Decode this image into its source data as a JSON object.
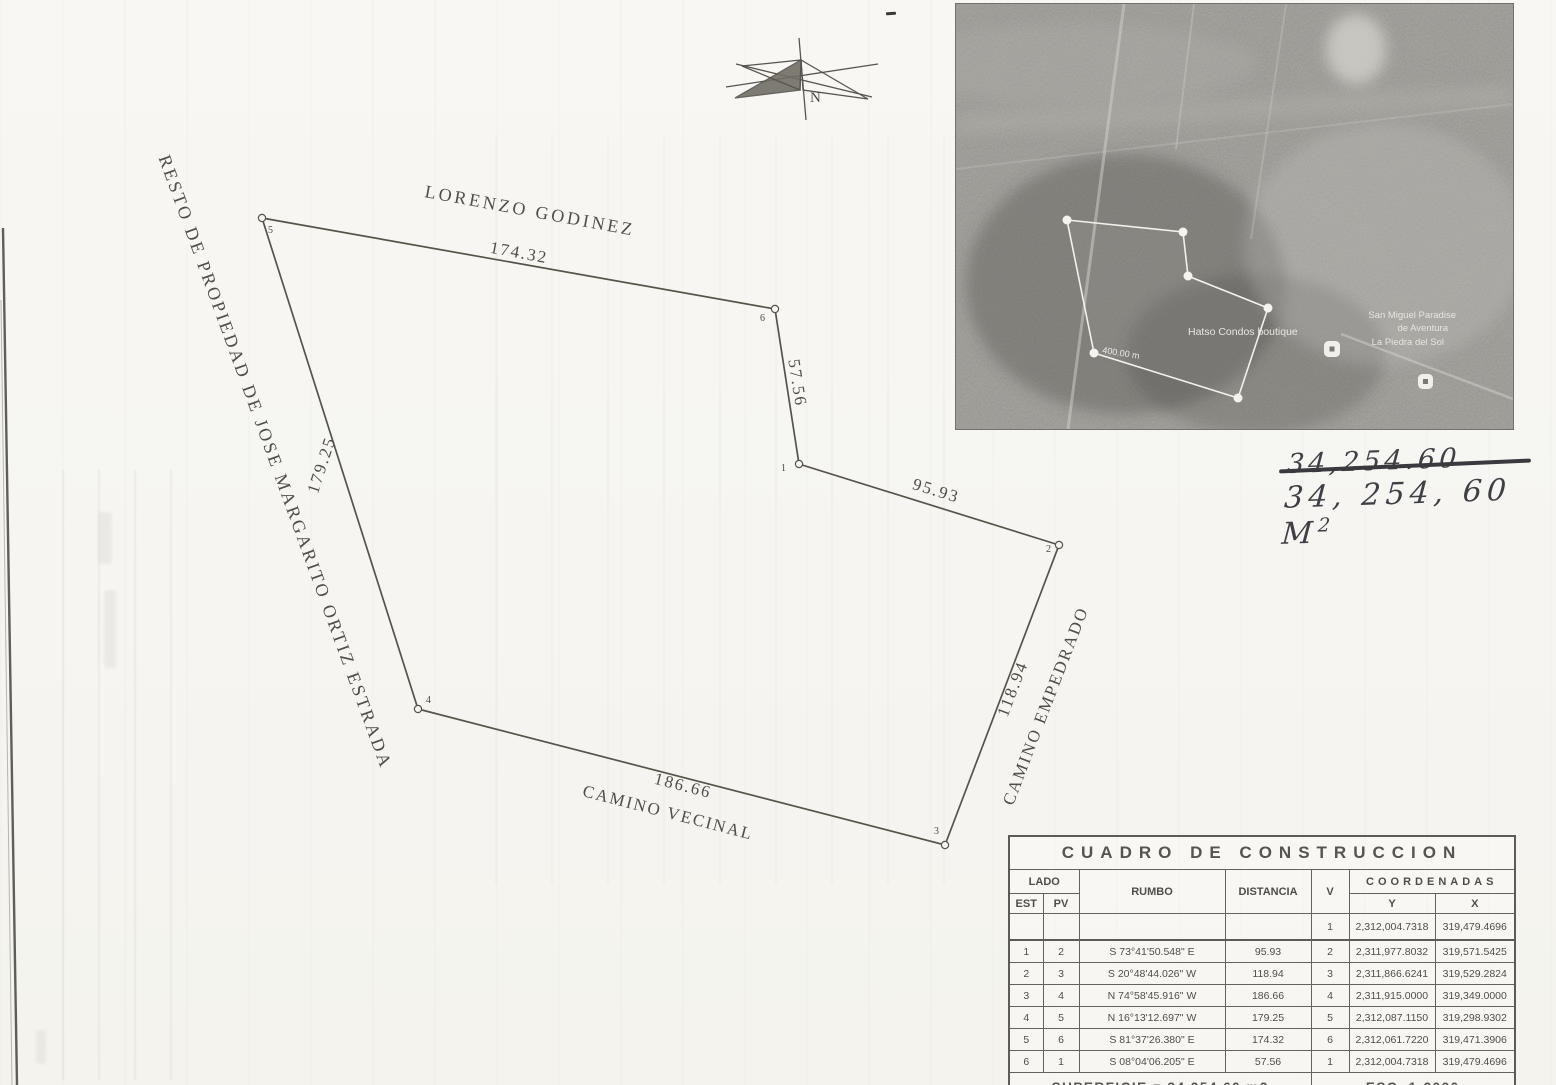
{
  "drawing": {
    "north_label": "N",
    "adjoiners": {
      "top": "LORENZO GODINEZ",
      "left": "RESTO DE PROPIEDAD DE JOSE MARGARITO ORTIZ ESTRADA"
    },
    "sides": {
      "s56": "174.32",
      "s61": "57.56",
      "s12": "95.93",
      "s23": "118.94",
      "s34": "186.66",
      "s45": "179.25"
    },
    "roads": {
      "empedrado": "CAMINO EMPEDRADO",
      "vecinal": "CAMINO VECINAL"
    },
    "vertices": [
      "1",
      "2",
      "3",
      "4",
      "5",
      "6"
    ]
  },
  "aerial": {
    "map_labels": {
      "place1": "Hatso Condos boutique",
      "place2": "San Miguel Paradise",
      "place3": "de Aventura",
      "place4": "La Piedra del Sol",
      "measurement": "400.00 m"
    }
  },
  "annotation": {
    "struck": "34,254.60",
    "value": "34, 254, 60",
    "unit": "M",
    "unit_sup": "2"
  },
  "table": {
    "title": "CUADRO DE CONSTRUCCION",
    "headers": {
      "lado": "LADO",
      "est": "EST",
      "pv": "PV",
      "rumbo": "RUMBO",
      "distancia": "DISTANCIA",
      "v": "V",
      "coordenadas": "COORDENADAS",
      "y": "Y",
      "x": "X"
    },
    "rows": [
      {
        "est": "",
        "pv": "",
        "rumbo": "",
        "distancia": "",
        "v": "1",
        "y": "2,312,004.7318",
        "x": "319,479.4696"
      },
      {
        "est": "1",
        "pv": "2",
        "rumbo": "S 73°41'50.548\" E",
        "distancia": "95.93",
        "v": "2",
        "y": "2,311,977.8032",
        "x": "319,571.5425"
      },
      {
        "est": "2",
        "pv": "3",
        "rumbo": "S 20°48'44.026\" W",
        "distancia": "118.94",
        "v": "3",
        "y": "2,311,866.6241",
        "x": "319,529.2824"
      },
      {
        "est": "3",
        "pv": "4",
        "rumbo": "N 74°58'45.916\" W",
        "distancia": "186.66",
        "v": "4",
        "y": "2,311,915.0000",
        "x": "319,349.0000"
      },
      {
        "est": "4",
        "pv": "5",
        "rumbo": "N 16°13'12.697\" W",
        "distancia": "179.25",
        "v": "5",
        "y": "2,312,087.1150",
        "x": "319,298.9302"
      },
      {
        "est": "5",
        "pv": "6",
        "rumbo": "S 81°37'26.380\" E",
        "distancia": "174.32",
        "v": "6",
        "y": "2,312,061.7220",
        "x": "319,471.3906"
      },
      {
        "est": "6",
        "pv": "1",
        "rumbo": "S 08°04'06.205\" E",
        "distancia": "57.56",
        "v": "1",
        "y": "2,312,004.7318",
        "x": "319,479.4696"
      }
    ],
    "footer": {
      "superficie": "SUPERFICIE = 34,254.60 m2",
      "escala": "ESC. 1:2000"
    }
  }
}
